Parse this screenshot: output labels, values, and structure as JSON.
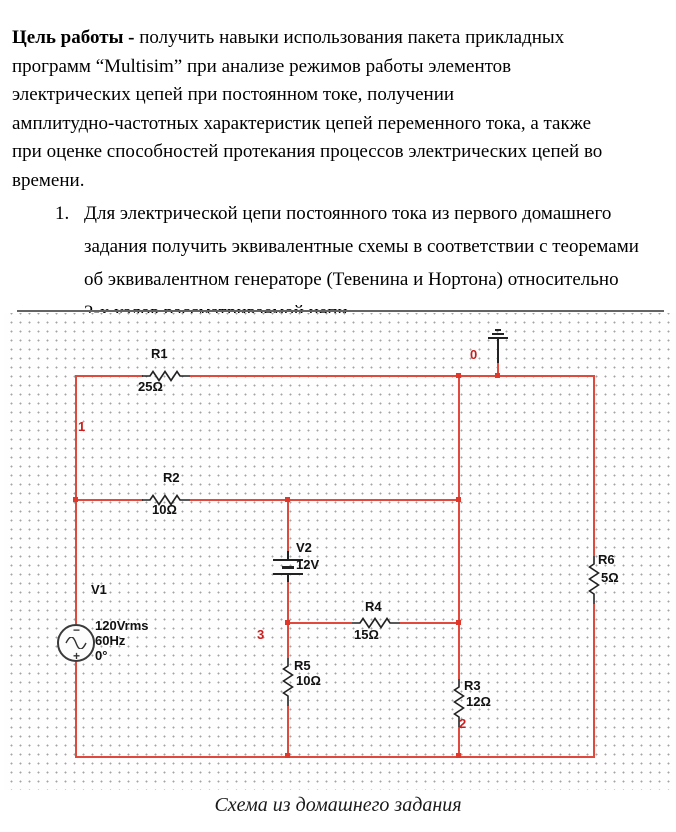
{
  "intro": {
    "bold": "Цель работы - ",
    "rest": "получить навыки использования пакета прикладных\nпрограмм “Multisim” при анализе режимов работы элементов\nэлектрических цепей при постоянном токе, получении\nамплитудно-частотных характеристик цепей переменного тока, а также\nпри оценке способностей протекания процессов электрических цепей во\nвремени."
  },
  "task": {
    "number": "1.",
    "text": "Для электрической цепи постоянного тока из первого домашнего\nзадания получить эквивалентные схемы в соответствии с теоремами\nоб эквивалентном генераторе (Тевенина и Нортона) относительно\n2-х узлов рассматриваемой цепи."
  },
  "circuit": {
    "components": {
      "r1": {
        "name": "R1",
        "value": "25Ω"
      },
      "r2": {
        "name": "R2",
        "value": "10Ω"
      },
      "r3": {
        "name": "R3",
        "value": "12Ω"
      },
      "r4": {
        "name": "R4",
        "value": "15Ω"
      },
      "r5": {
        "name": "R5",
        "value": "10Ω"
      },
      "r6": {
        "name": "R6",
        "value": "5Ω"
      },
      "v1": {
        "name": "V1",
        "value": "120Vrms\n60Hz\n0°",
        "polarity_minus": "−",
        "polarity_plus": "+"
      },
      "v2": {
        "name": "V2",
        "value": "12V"
      }
    },
    "nodes": {
      "n0": "0",
      "n1": "1",
      "n2": "2",
      "n3": "3"
    },
    "colors": {
      "wire": "#e0493b",
      "node_label": "#c81e1e",
      "component_label": "#111111",
      "grid_dot": "#a3a3a3"
    }
  },
  "caption": "Схема из домашнего задания"
}
